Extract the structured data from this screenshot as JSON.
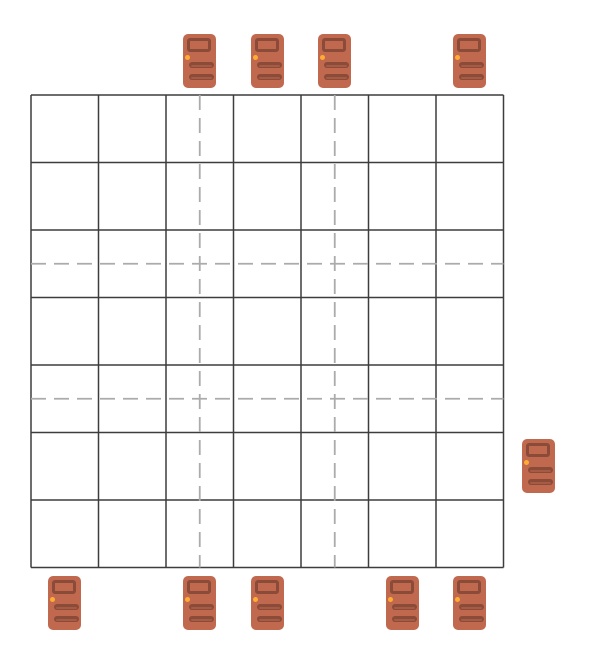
{
  "board": {
    "rows": 7,
    "cols": 7,
    "background": "#ffffff",
    "line_color": "#3d3d3d",
    "dashed_line_color": "#ababab",
    "dashed_vertical_cols": [
      3,
      5
    ],
    "dashed_horizontal_rows": [
      3,
      5
    ]
  },
  "doors": {
    "count": 10,
    "top_cols": [
      3,
      4,
      5,
      7
    ],
    "right_rows": [
      6
    ],
    "bottom_cols": [
      1,
      3,
      4,
      6,
      7
    ],
    "left_rows": [],
    "colors": {
      "body": "#C1694F",
      "panel": "#8A4B38",
      "panel_highlight": "#A85B44",
      "knob": "#FFAC33"
    }
  }
}
